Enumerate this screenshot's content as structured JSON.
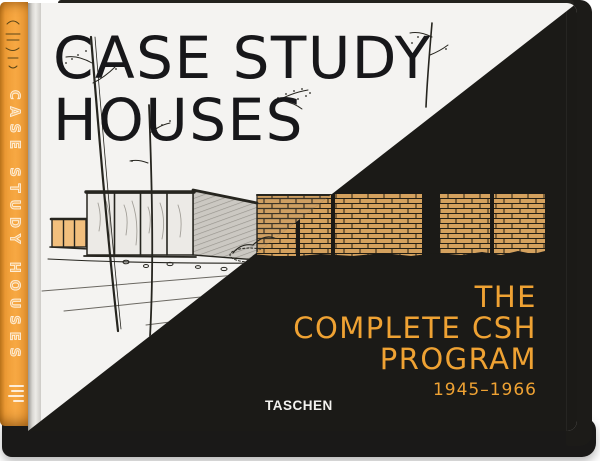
{
  "book": {
    "front_cover": {
      "title_line1": "CASE STUDY",
      "title_line2": "HOUSES",
      "subtitle_lines": [
        "THE",
        "COMPLETE CSH",
        "PROGRAM"
      ],
      "years": "1945–1966",
      "publisher": "TASCHEN"
    },
    "spine": {
      "title": "CASE STUDY HOUSES"
    },
    "colors": {
      "spine_orange": "#F5A03A",
      "accent_orange": "#EFA233",
      "cover_white": "#F4F3F1",
      "cover_black": "#1B1A17",
      "title_ink": "#17171A",
      "brick": "#D4A15E"
    }
  }
}
